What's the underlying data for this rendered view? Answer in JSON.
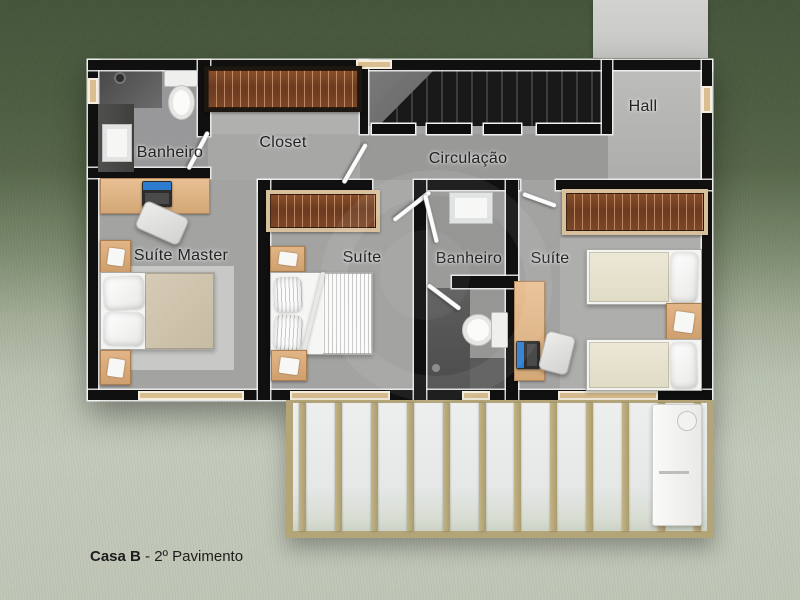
{
  "labels": {
    "banheiro_master": "Banheiro",
    "closet": "Closet",
    "hall": "Hall",
    "circulacao": "Circulação",
    "suite_master": "Suíte Master",
    "suite_middle": "Suíte",
    "banheiro_middle": "Banheiro",
    "suite_right": "Suíte"
  },
  "caption": {
    "name": "Casa B",
    "floor": " - 2º Pavimento"
  },
  "colors": {
    "grass_dark": "#44543a",
    "pavement_light": "#c3cabb",
    "wall": "#101010",
    "floor_gray": "#a3a3a2",
    "concrete_path": "#cbcbc9",
    "furniture_wood": "#ddb082",
    "wardrobe_wood": "#6b3a20",
    "pergola_wood": "#b3a577",
    "window_frame": "#d9be8f",
    "bed_master_duvet": "#cec3ac",
    "bed_single_duvet": "#e9e5d2",
    "laptop_screen": "#2e7cd0"
  }
}
